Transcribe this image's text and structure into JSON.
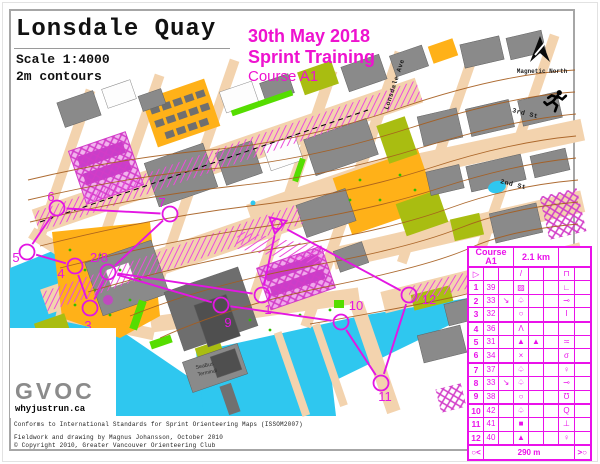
{
  "header": {
    "title": "Lonsdale Quay",
    "scale": "Scale 1:4000",
    "contours": "2m contours",
    "event_date": "30th May 2018",
    "event_name": "Sprint Training",
    "course": "Course A1",
    "magnetic_north_label": "Magnetic North"
  },
  "colors": {
    "course_magenta": "#e316e3",
    "header_text_magenta": "#ee12cf",
    "card_magenta": "#ea11ea",
    "water_cyan": "#2fc7ef",
    "open_land_orange": "#ffb118",
    "forbidden_olive": "#a9bd11",
    "vegetation_green": "#55dd00",
    "paved_tan": "#f3d3ae",
    "building_gray": "#8a8a8a",
    "contour_brown": "#a65d1e"
  },
  "map": {
    "street_labels": [
      {
        "text": "Lonsdale Ave"
      },
      {
        "text": "3rd St"
      },
      {
        "text": "2nd St"
      }
    ],
    "poi": {
      "line1": "SeaBus",
      "line2": "Terminal"
    },
    "start_finish": {
      "x": 277,
      "y": 224
    },
    "leg_order": [
      "SF",
      "1",
      "2/8",
      "3",
      "4",
      "5",
      "6",
      "7",
      "2/8",
      "9",
      "10",
      "11",
      "12",
      "SF"
    ],
    "controls": [
      {
        "num": "1",
        "cx": 262,
        "cy": 295,
        "lx": 268,
        "ly": 314
      },
      {
        "num": "2/8",
        "cx": 108,
        "cy": 272,
        "lx": 99,
        "ly": 262
      },
      {
        "num": "3",
        "cx": 90,
        "cy": 308,
        "lx": 88,
        "ly": 330
      },
      {
        "num": "4",
        "cx": 75,
        "cy": 266,
        "lx": 61,
        "ly": 278
      },
      {
        "num": "5",
        "cx": 27,
        "cy": 252,
        "lx": 16,
        "ly": 262
      },
      {
        "num": "6",
        "cx": 57,
        "cy": 208,
        "lx": 51,
        "ly": 201
      },
      {
        "num": "7",
        "cx": 170,
        "cy": 214,
        "lx": 162,
        "ly": 207
      },
      {
        "num": "9",
        "cx": 221,
        "cy": 305,
        "lx": 228,
        "ly": 327
      },
      {
        "num": "10",
        "cx": 341,
        "cy": 322,
        "lx": 356,
        "ly": 310
      },
      {
        "num": "11",
        "cx": 381,
        "cy": 383,
        "lx": 385,
        "ly": 401
      },
      {
        "num": "12",
        "cx": 409,
        "cy": 295,
        "lx": 429,
        "ly": 304
      }
    ]
  },
  "control_card": {
    "course_label": "Course A1",
    "length_label": "2.1 km",
    "rows": [
      {
        "a": "▷",
        "b": "",
        "c": "",
        "d": "/",
        "e": "",
        "f": "",
        "g": "⊓",
        "h": ""
      },
      {
        "a": "1",
        "b": "39",
        "c": "",
        "d": "▨",
        "e": "",
        "f": "",
        "g": "∟",
        "h": ""
      },
      {
        "a": "2",
        "b": "33",
        "c": "↘",
        "d": "♤",
        "e": "",
        "f": "",
        "g": "⊸",
        "h": ""
      },
      {
        "a": "3",
        "b": "32",
        "c": "",
        "d": "○",
        "e": "",
        "f": "",
        "g": "I",
        "h": ""
      },
      {
        "a": "4",
        "b": "36",
        "c": "",
        "d": "Λ",
        "e": "",
        "f": "",
        "g": "",
        "h": ""
      },
      {
        "a": "5",
        "b": "31",
        "c": "",
        "d": "▲",
        "e": "▲",
        "f": "",
        "g": "≍",
        "h": ""
      },
      {
        "a": "6",
        "b": "34",
        "c": "",
        "d": "×",
        "e": "",
        "f": "",
        "g": "σ",
        "h": ""
      },
      {
        "a": "7",
        "b": "37",
        "c": "",
        "d": "♤",
        "e": "",
        "f": "",
        "g": "♀",
        "h": ""
      },
      {
        "a": "8",
        "b": "33",
        "c": "↘",
        "d": "♤",
        "e": "",
        "f": "",
        "g": "⊸",
        "h": ""
      },
      {
        "a": "9",
        "b": "38",
        "c": "",
        "d": "○",
        "e": "",
        "f": "",
        "g": "Ʊ",
        "h": ""
      },
      {
        "a": "10",
        "b": "42",
        "c": "",
        "d": "♤",
        "e": "",
        "f": "",
        "g": "Q",
        "h": ""
      },
      {
        "a": "11",
        "b": "41",
        "c": "",
        "d": "■",
        "e": "",
        "f": "",
        "g": "⊥",
        "h": ""
      },
      {
        "a": "12",
        "b": "40",
        "c": "",
        "d": "▲",
        "e": "",
        "f": "",
        "g": "♀",
        "h": ""
      }
    ],
    "finish": {
      "left_symbol": "○<",
      "distance": "290 m",
      "right_symbol": ">○"
    }
  },
  "logo": {
    "org": "GVOC",
    "url_text": "whyjustrun.ca"
  },
  "footer": {
    "line1": "Conforms to International Standards for Sprint Orienteering Maps (ISSOM2007)",
    "line2": "Fieldwork and drawing by Magnus Johansson, October 2010",
    "line3": "© Copyright 2010, Greater Vancouver Orienteering Club"
  }
}
